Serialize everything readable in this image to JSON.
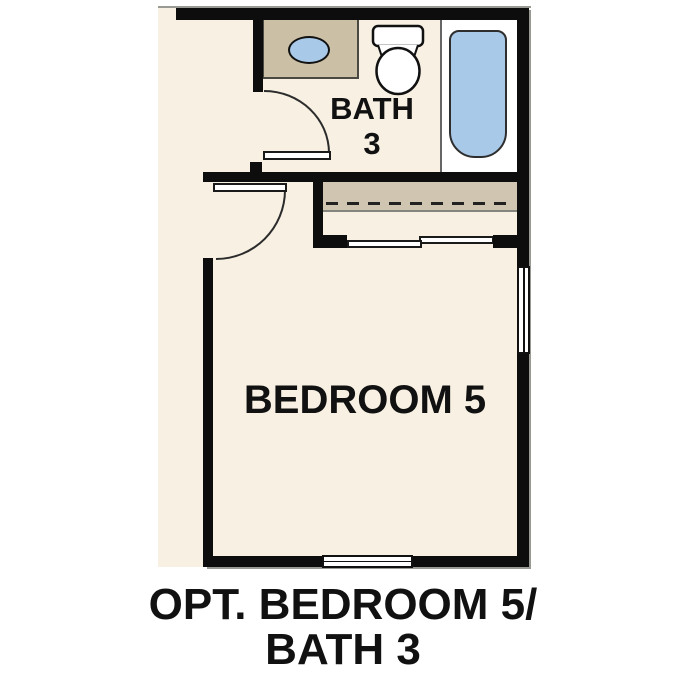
{
  "labels": {
    "bath_room": {
      "line1": "BATH",
      "line2": "3"
    },
    "bedroom": "BEDROOM 5",
    "caption": {
      "line1": "OPT. BEDROOM 5/",
      "line2": "BATH 3"
    }
  },
  "colors": {
    "floor": "#F7F0E3",
    "wall": "#0D0D0D",
    "cabinet_tan": "#CBC0A5",
    "closet_tan": "#CFC5B1",
    "fixture_blue": "#A9C9E9",
    "line_gray": "#9A9A94",
    "text": "#111111"
  }
}
